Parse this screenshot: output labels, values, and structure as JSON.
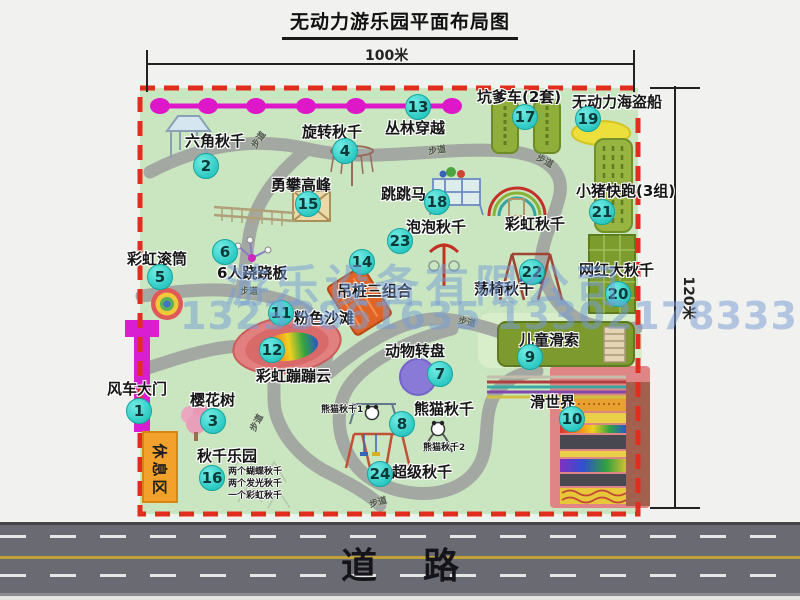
{
  "title": "无动力游乐园平面布局图",
  "dimensions": {
    "width": "100米",
    "height": "120米"
  },
  "road": {
    "label": "道路"
  },
  "rest_area": {
    "label": "休息区"
  },
  "walkway_label": "步道",
  "watermark": {
    "line1": "游乐设备有限公司",
    "line2": "13233861635 13302178333"
  },
  "attractions": [
    {
      "num": "1",
      "label": "风车大门"
    },
    {
      "num": "2",
      "label": "六角秋千"
    },
    {
      "num": "3",
      "label": "樱花树"
    },
    {
      "num": "4",
      "label": "旋转秋千"
    },
    {
      "num": "5",
      "label": "彩虹滚筒"
    },
    {
      "num": "6",
      "label": "6人跷跷板"
    },
    {
      "num": "7",
      "label": "动物转盘"
    },
    {
      "num": "8",
      "label": "熊猫秋千"
    },
    {
      "num": "9",
      "label": "儿童滑索"
    },
    {
      "num": "10",
      "label": "滑世界"
    },
    {
      "num": "11",
      "label": "粉色沙滩"
    },
    {
      "num": "12",
      "label": "彩虹蹦蹦云"
    },
    {
      "num": "13",
      "label": "丛林穿越"
    },
    {
      "num": "14",
      "label": "吊桩三组合"
    },
    {
      "num": "15",
      "label": "勇攀高峰"
    },
    {
      "num": "16",
      "label": "秋千乐园"
    },
    {
      "num": "17",
      "label": "坑爹车(2套)"
    },
    {
      "num": "18",
      "label": "跳跳马"
    },
    {
      "num": "19",
      "label": "无动力海盗船"
    },
    {
      "num": "20",
      "label": "网红大秋千"
    },
    {
      "num": "21",
      "label": "小猪快跑(3组)"
    },
    {
      "num": "22",
      "label": "荡椅秋千"
    },
    {
      "num": "23",
      "label": "泡泡秋千"
    },
    {
      "num": "24",
      "label": "超级秋千"
    }
  ],
  "extra": {
    "rainbow_swing": "彩虹秋千",
    "panda_swing_1": "熊猫秋千1",
    "panda_swing_2": "熊猫秋千2",
    "swing_park_items": [
      "两个蝴蝶秋千",
      "两个发光秋千",
      "一个彩虹秋千"
    ]
  },
  "colors": {
    "map_green": "#c9e6c0",
    "border_red": "#e22c1e",
    "marker_cyan": "#2cc8c2",
    "zipline_magenta": "#de18c8",
    "rest_area_orange": "#f2a12c",
    "road_gray": "#6a6a72"
  }
}
